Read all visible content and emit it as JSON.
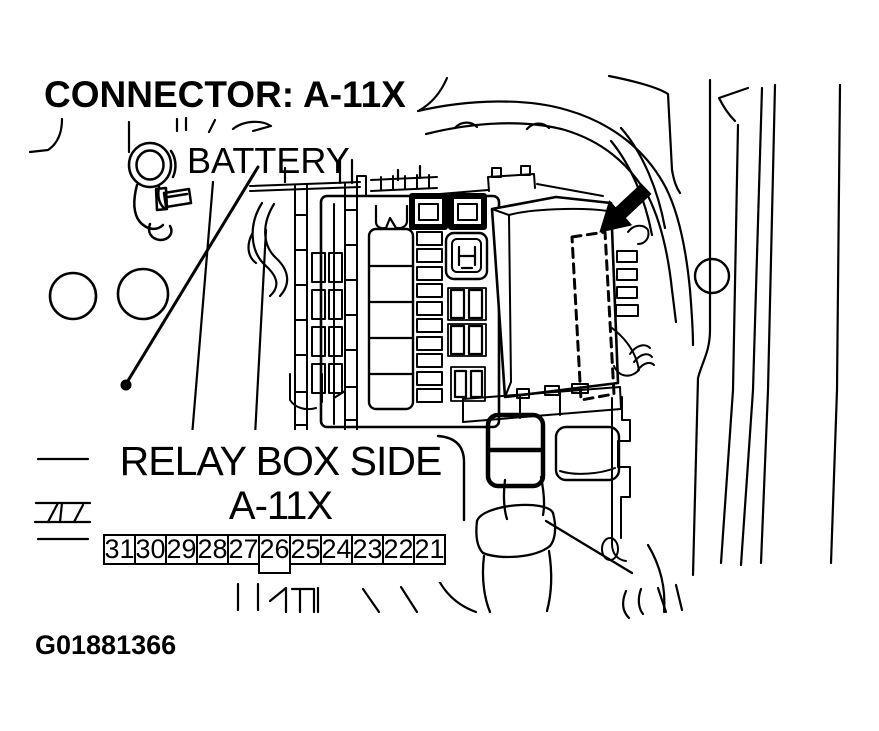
{
  "title": "CONNECTOR: A-11X",
  "figure_id": "G01881366",
  "labels": {
    "battery": "BATTERY"
  },
  "callout": {
    "line1": "RELAY BOX SIDE",
    "line2": "A-11X",
    "pins": [
      "31",
      "30",
      "29",
      "28",
      "27",
      "26",
      "25",
      "24",
      "23",
      "22",
      "21"
    ],
    "highlighted_pin": "26"
  },
  "icons": {
    "pointer_arrow": "solid-arrow-indicating-connector-a11x"
  },
  "colors": {
    "line": "#000000",
    "background": "#ffffff"
  }
}
